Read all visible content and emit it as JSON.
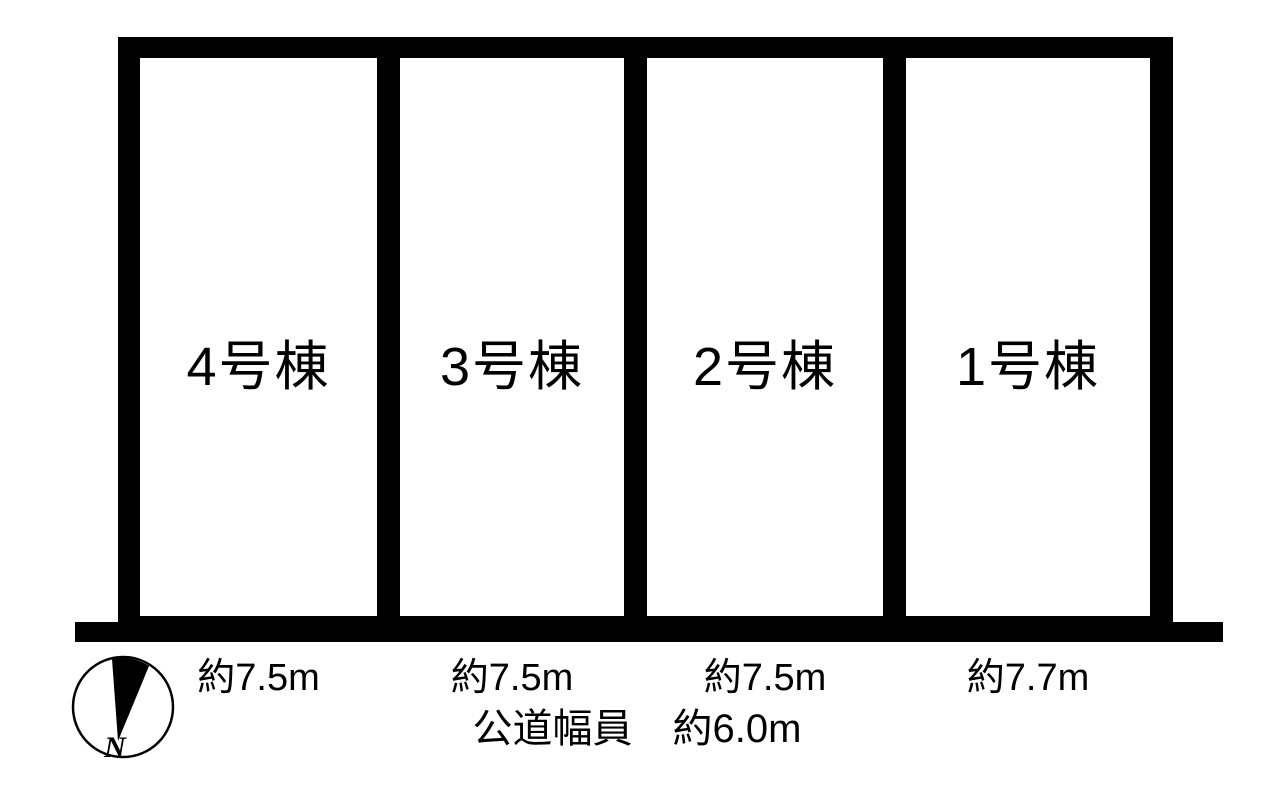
{
  "diagram": {
    "lots": [
      {
        "name": "4号棟",
        "width": "約7.5m"
      },
      {
        "name": "3号棟",
        "width": "約7.5m"
      },
      {
        "name": "2号棟",
        "width": "約7.5m"
      },
      {
        "name": "1号棟",
        "width": "約7.7m"
      }
    ],
    "road": {
      "label": "公道幅員　約6.0m"
    },
    "compass": {
      "north_label": "N"
    },
    "colors": {
      "ink": "#000000",
      "paper": "#ffffff"
    }
  }
}
